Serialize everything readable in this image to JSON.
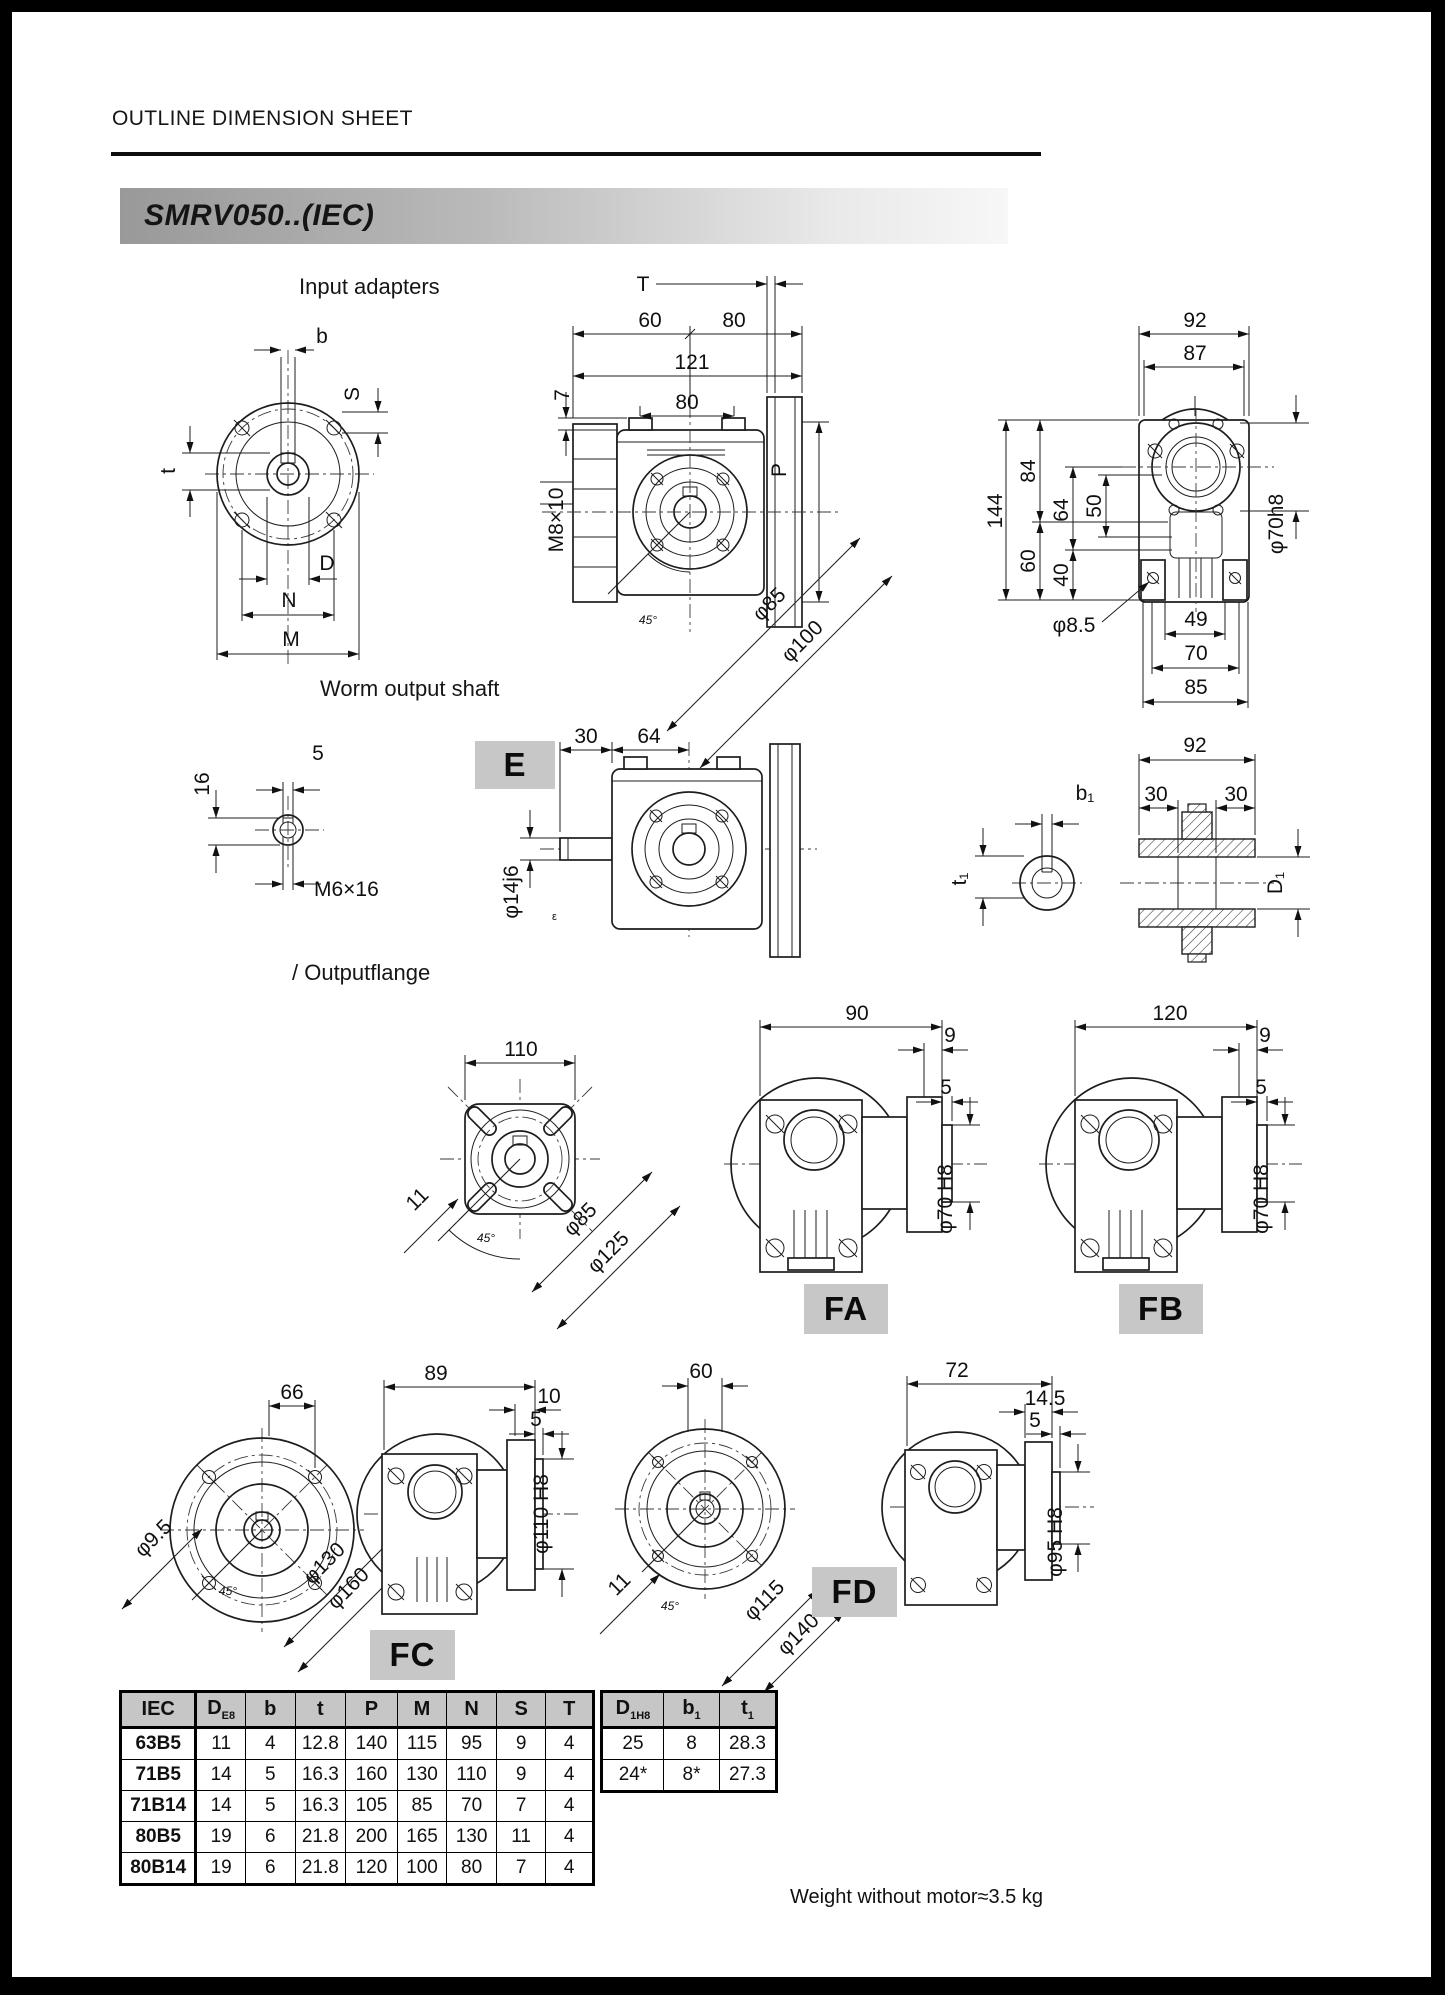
{
  "page": {
    "title": "OUTLINE DIMENSION SHEET",
    "banner": "SMRV050..(IEC)",
    "weight_note": "Weight without motor≈3.5 kg"
  },
  "sections": {
    "input_adapters": "Input adapters",
    "worm_output_shaft": "Worm output shaft",
    "output_flange": "/ Outputflange"
  },
  "badges": {
    "e": "E",
    "fa": "FA",
    "fb": "FB",
    "fc": "FC",
    "fd": "FD"
  },
  "dims": {
    "input_front": {
      "b": "b",
      "s": "S",
      "t": "t",
      "d": "D",
      "n": "N",
      "m": "M"
    },
    "input_side": {
      "d60": "60",
      "d80a": "80",
      "d121": "121",
      "d80b": "80",
      "d7": "7",
      "thread": "M8×10",
      "t": "T",
      "p": "P",
      "phi85": "φ85",
      "phi100": "φ100",
      "a45": "45°"
    },
    "input_rear": {
      "d92": "92",
      "d87": "87",
      "d144": "144",
      "d84": "84",
      "d64": "64",
      "d50": "50",
      "d60": "60",
      "d40": "40",
      "phi70": "φ70h8",
      "phi8_5": "φ8.5",
      "d49": "49",
      "d70": "70",
      "d85": "85"
    },
    "shaft_end": {
      "d5": "5",
      "d16": "16",
      "thread": "M6×16"
    },
    "worm_side": {
      "d30": "30",
      "d64": "64",
      "phi14": "φ14j6",
      "mark": "ε"
    },
    "bushing": {
      "b1": "b₁",
      "t1": "t₁",
      "d92": "92",
      "d30a": "30",
      "d30b": "30",
      "dd1": "D₁"
    },
    "out_flange": {
      "d110": "110",
      "d11": "11",
      "a45": "45°",
      "phi85": "φ85",
      "phi125": "φ125"
    },
    "fa": {
      "d90": "90",
      "d9": "9",
      "d5": "5",
      "phi70": "φ70 H8"
    },
    "fb": {
      "d120": "120",
      "d9": "9",
      "d5": "5",
      "phi70": "φ70 H8"
    },
    "fc_front": {
      "d66": "66",
      "phi9_5": "φ9.5",
      "phi130": "φ130",
      "phi160": "φ160",
      "a45": "45°"
    },
    "fc_side": {
      "d89": "89",
      "d10": "10",
      "d5": "5",
      "phi110": "φ110 H8"
    },
    "fd_front": {
      "d60": "60",
      "d11": "11",
      "phi115": "φ115",
      "phi140": "φ140",
      "a45": "45°"
    },
    "fd_side": {
      "d72": "72",
      "d14_5": "14.5",
      "d5": "5",
      "phi95": "φ95 H8"
    }
  },
  "table": {
    "h_iec": "IEC",
    "h_d": "D",
    "h_d_sub": "E8",
    "h_b": "b",
    "h_t": "t",
    "h_p": "P",
    "h_m": "M",
    "h_n": "N",
    "h_s": "S",
    "h_t2": "T",
    "h_d1": "D",
    "h_d1_sub": "1H8",
    "h_b1": "b",
    "h_b1_sub": "1",
    "h_t1": "t",
    "h_t1_sub": "1",
    "rows": [
      [
        "63B5",
        "11",
        "4",
        "12.8",
        "140",
        "115",
        "95",
        "9",
        "4"
      ],
      [
        "71B5",
        "14",
        "5",
        "16.3",
        "160",
        "130",
        "110",
        "9",
        "4"
      ],
      [
        "71B14",
        "14",
        "5",
        "16.3",
        "105",
        "85",
        "70",
        "7",
        "4"
      ],
      [
        "80B5",
        "19",
        "6",
        "21.8",
        "200",
        "165",
        "130",
        "11",
        "4"
      ],
      [
        "80B14",
        "19",
        "6",
        "21.8",
        "120",
        "100",
        "80",
        "7",
        "4"
      ]
    ],
    "rows2": [
      [
        "25",
        "8",
        "28.3"
      ],
      [
        "24*",
        "8*",
        "27.3"
      ]
    ]
  }
}
